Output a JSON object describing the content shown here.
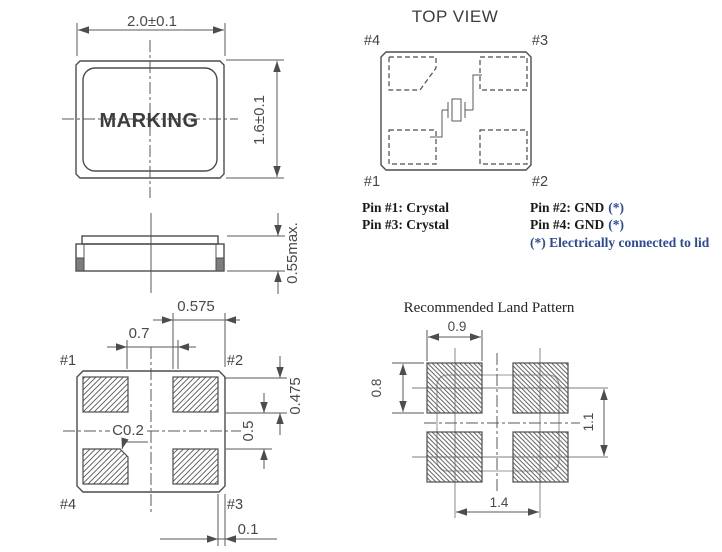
{
  "front_view": {
    "width_dim": "2.0±0.1",
    "height_dim": "1.6±0.1",
    "marking": "MARKING"
  },
  "side_view": {
    "height_dim": "0.55max."
  },
  "top_view": {
    "title": "TOP VIEW",
    "pin_tl": "#4",
    "pin_tr": "#3",
    "pin_bl": "#1",
    "pin_br": "#2"
  },
  "pin_assignments": {
    "pin1": "Pin #1: Crystal",
    "pin3": "Pin #3: Crystal",
    "pin2": "Pin #2: GND",
    "pin2_star": "(*)",
    "pin4": "Pin #4: GND",
    "pin4_star": "(*)",
    "footnote": "(*) Electrically connected to lid"
  },
  "bottom_view": {
    "pin_tl": "#1",
    "pin_tr": "#2",
    "pin_bl": "#4",
    "pin_br": "#3",
    "dim_pad_length": "0.575",
    "dim_pad_gap": "0.7",
    "dim_pad_height": "0.475",
    "dim_pad_vgap": "0.5",
    "dim_edge_margin": "0.1",
    "chamfer_note": "C0.2"
  },
  "land_pattern": {
    "title": "Recommended Land Pattern",
    "dim_pad_width": "0.9",
    "dim_pad_height": "0.8",
    "dim_pitch_vertical": "1.1",
    "dim_pitch_horizontal": "1.4"
  },
  "colors": {
    "drawing_line": "#4d4d4d",
    "dimension_text": "#4a4a4a",
    "pin_text": "#1a1a1a",
    "note_blue": "#2b4a9b"
  }
}
